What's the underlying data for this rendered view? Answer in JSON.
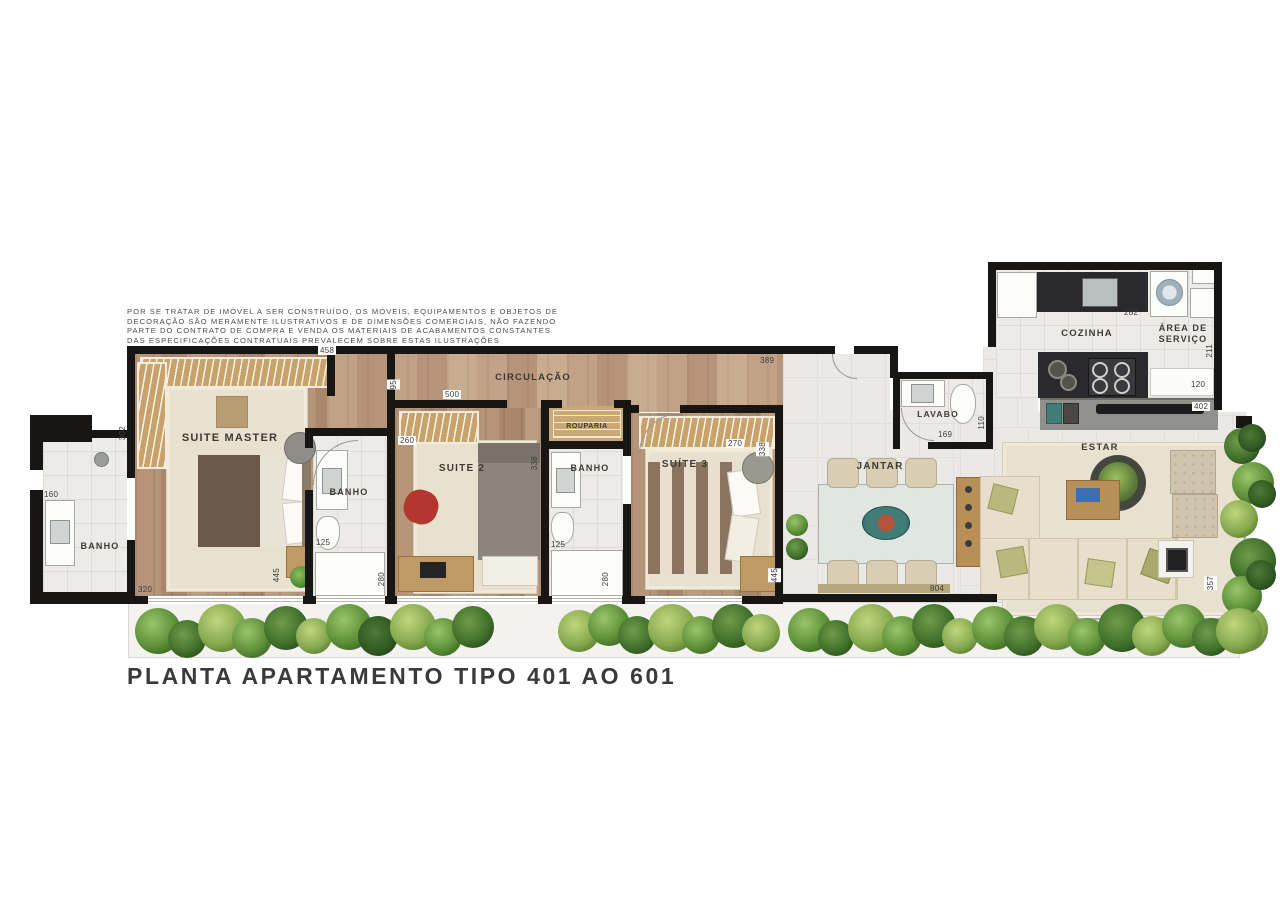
{
  "title": "PLANTA APARTAMENTO TIPO 401 AO 601",
  "disclaimer": {
    "l1": "POR SE TRATAR DE IMÓVEL A SER CONSTRUÍDO, OS MÓVEIS, EQUIPAMENTOS E OBJETOS DE",
    "l2": "DECORAÇÃO SÃO MERAMENTE ILUSTRATIVOS E DE DIMENSÕES COMERCIAIS, NÃO FAZENDO",
    "l3": "PARTE DO CONTRATO DE COMPRA E VENDA  OS MATERIAIS DE ACABAMENTOS CONSTANTES",
    "l4": "DAS ESPECIFICAÇÕES CONTRATUAIS PREVALECEM SOBRE ESTAS ILUSTRAÇÕES"
  },
  "rooms": {
    "banho_master": "BANHO",
    "suite_master": "SUITE MASTER",
    "banho2": "BANHO",
    "suite2": "SUITE 2",
    "circulacao": "CIRCULAÇÃO",
    "rouparia": "ROUPARIA",
    "banho3": "BANHO",
    "suite3": "SUÍTE 3",
    "jantar": "JANTAR",
    "lavabo": "LAVABO",
    "cozinha": "COZINHA",
    "area_servico": "ÁREA DE SERVIÇO",
    "estar": "ESTAR"
  },
  "dims": {
    "banho_master_top": "160",
    "banho_master_side": "302",
    "suite_master_bottom": "320",
    "suite_master_top": "458",
    "suite_master_side": "445",
    "banho2_width": "125",
    "banho2_side": "280",
    "suite2_step": "95",
    "suite2_top": "500",
    "suite2_closet": "260",
    "suite2_side": "338",
    "banho3_width": "125",
    "banho3_side": "280",
    "suite3_closet_top": "270",
    "suite3_closet_side": "338",
    "hall_top": "389",
    "suite3_side": "445",
    "jantar_bottom": "804",
    "lavabo_width": "169",
    "lavabo_side": "110",
    "cozinha_counter": "282",
    "servico_side": "211",
    "servico_shelf": "120",
    "cozinha_bottom": "402",
    "estar_side": "357"
  },
  "colors": {
    "wall": "#171614",
    "wood_floor": "#b59478",
    "rug": "#e8e1d0",
    "tile": "#ecebe7",
    "greenery": "#5c8f38"
  }
}
